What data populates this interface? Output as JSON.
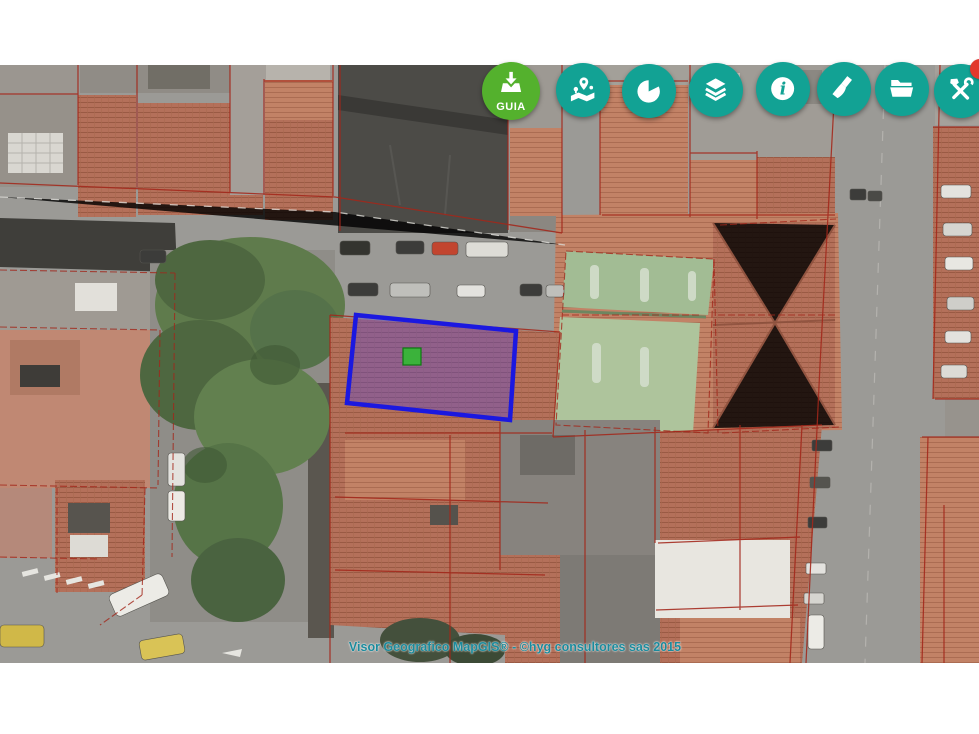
{
  "app": {
    "name": "MapGIS visor geografico"
  },
  "map": {
    "attribution": "Visor Geografico MapGIS® - ©hyg consultores sas 2015",
    "selected_parcel": {
      "points": "356,250 516,266 510,355 347,338",
      "marker": {
        "x": "403",
        "y": "283"
      }
    }
  },
  "toolbar": {
    "buttons": [
      {
        "id": "guia",
        "label": "GUIA",
        "icon": "download-icon",
        "color": "#54b12d"
      },
      {
        "id": "locate",
        "label": "",
        "icon": "map-pins-icon",
        "color": "#12a294"
      },
      {
        "id": "charts",
        "label": "",
        "icon": "pie-chart-icon",
        "color": "#12a294"
      },
      {
        "id": "layers",
        "label": "",
        "icon": "layers-icon",
        "color": "#12a294"
      },
      {
        "id": "info",
        "label": "",
        "icon": "info-icon",
        "color": "#12a294"
      },
      {
        "id": "clean",
        "label": "",
        "icon": "broom-icon",
        "color": "#12a294"
      },
      {
        "id": "files",
        "label": "",
        "icon": "folder-icon",
        "color": "#12a294"
      },
      {
        "id": "tools",
        "label": "",
        "icon": "tools-icon",
        "color": "#12a294",
        "badge": true
      }
    ]
  },
  "colors": {
    "teal": "#12a294",
    "guiaGreen": "#54b12d",
    "badgeRed": "#e2372b",
    "parcelStroke": "#1b18e0",
    "parcelFill": "rgba(82,70,225,0.36)",
    "markerGreen": "#3bb23b",
    "cadastralRed": "#a3271a",
    "streetGray": "#9b9a96",
    "roofTerracotta": "#b4705a",
    "roofDark": "#4c4b47",
    "roofGray": "#96918a",
    "courtGreen": "#a2bc94",
    "treeGreen": "#5f7b4c",
    "attributionTeal": "#1b8a9c"
  }
}
